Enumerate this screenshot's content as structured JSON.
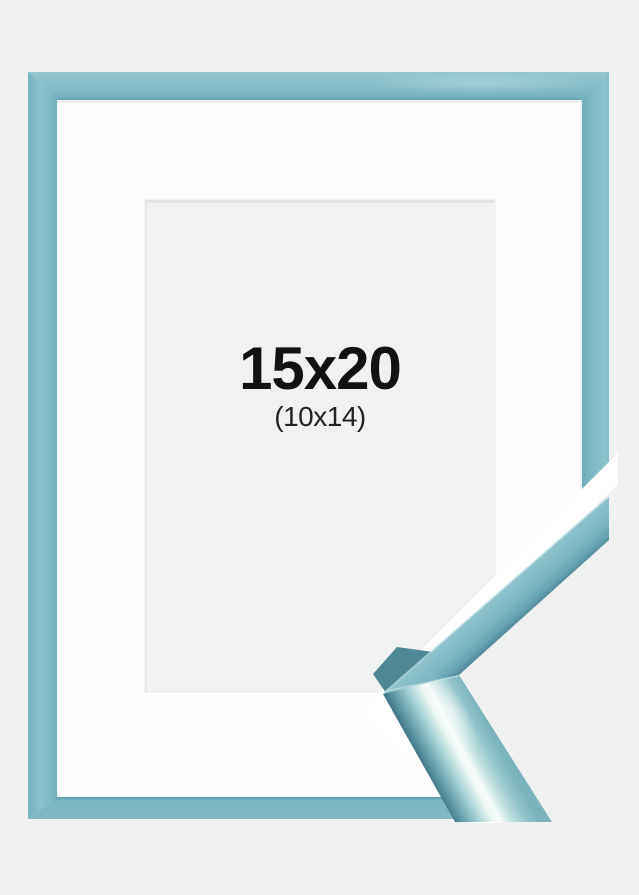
{
  "product": {
    "image_label": "light blue picture frame with white mat and corner profile sample",
    "outer_size": "15x20",
    "inner_size": "(10x14)"
  },
  "colors": {
    "background": "#eff0f0",
    "frame_blue": "#80bac6",
    "frame_blue_dark": "#5d98a7",
    "frame_gloss_highlight": "#f5fbf8",
    "mat_white": "#fdfdfd",
    "opening_gray": "#f0f1f1",
    "text_black": "#121212"
  }
}
